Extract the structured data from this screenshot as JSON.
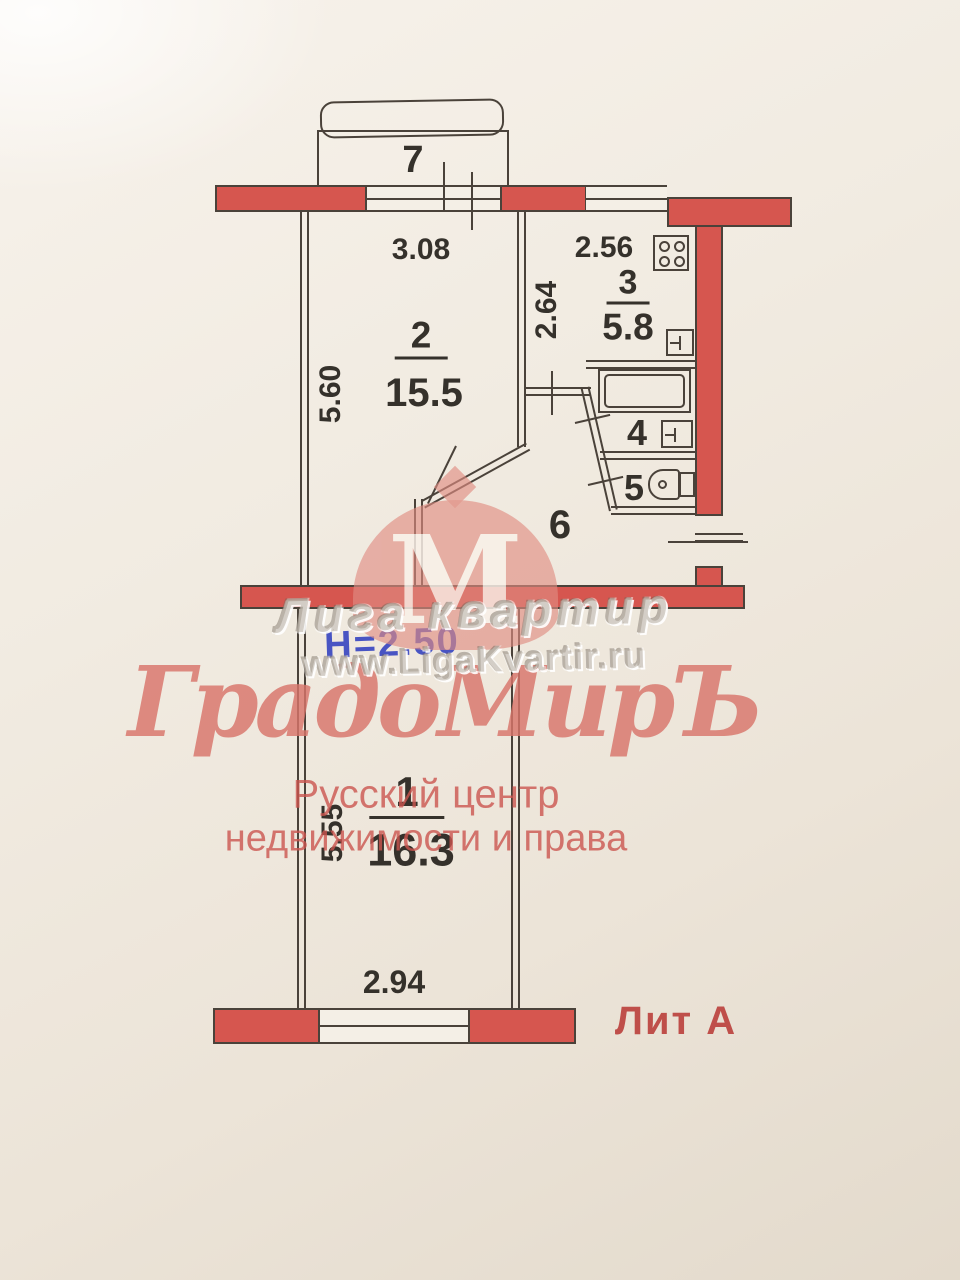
{
  "plan": {
    "litera": "Лит А",
    "ceiling_height": "Н=2.50",
    "balcony": {
      "number": "7"
    },
    "room2": {
      "number": "2",
      "area": "15.5",
      "width": "3.08",
      "height": "5.60"
    },
    "kitchen": {
      "number": "3",
      "area": "5.8",
      "width": "2.56",
      "height": "2.64"
    },
    "bathroom": {
      "number": "4"
    },
    "wc": {
      "number": "5"
    },
    "hallway": {
      "number": "6"
    },
    "room1": {
      "number": "1",
      "area": "16.3",
      "width": "2.94",
      "height": "5.55"
    }
  },
  "watermarks": {
    "agency_top_line": "Лига квартир",
    "agency_top_url": "www.LigaKvartir.ru",
    "agency_main_name": "ГрадоМирЪ",
    "agency_main_logo_letter": "М",
    "agency_main_sub1": "Русский центр",
    "agency_main_sub2": "недвижимости и права"
  },
  "icons": {
    "stove": "stove-icon",
    "kitchen_sink": "sink-icon",
    "washbasin": "washbasin-icon",
    "toilet": "toilet-icon",
    "bathtub": "bathtub-icon"
  },
  "colors": {
    "wall_fill": "#d6564f",
    "line": "#4a423a",
    "label_text": "#35312b",
    "litera_text": "#bf4f4a",
    "stamp_blue": "#2b3bbf",
    "watermark_pink": "#dd8077",
    "watermark_gray": "#b7aea3",
    "paper": "#f0e9de"
  }
}
